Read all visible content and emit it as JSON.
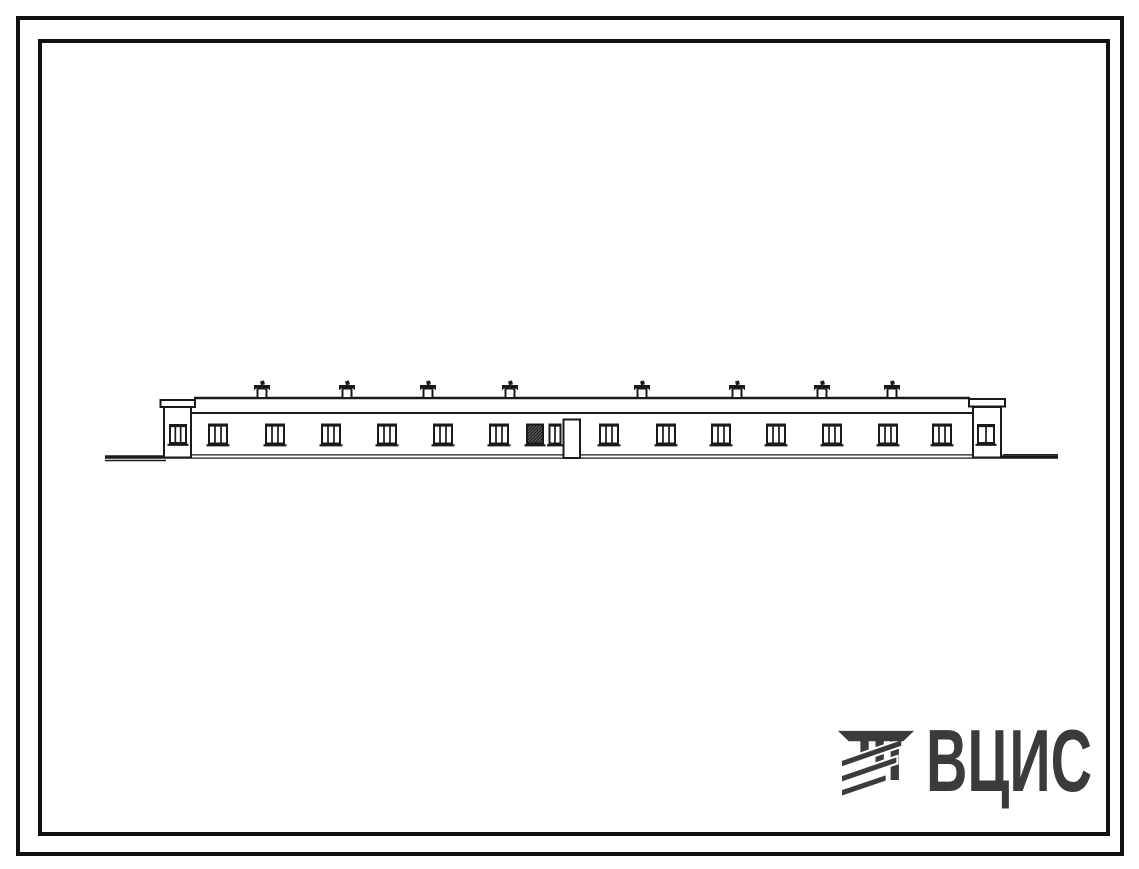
{
  "page": {
    "background": "#ffffff",
    "ink": "#1a1a1a"
  },
  "frame": {
    "style": "double rectangular plate border",
    "border_color": "#111111"
  },
  "logo": {
    "text": "ВЦИС",
    "color": "#3b3b3d",
    "icon": "hatched-beam-monogram"
  },
  "drawing": {
    "subject": "front elevation of long single-story building",
    "ground": {
      "x1": 105,
      "x2": 1058,
      "y": 457
    },
    "building": {
      "left": 191,
      "right": 973,
      "wall_top": 413,
      "roof_line_y": 398,
      "roof_x1": 194,
      "roof_x2": 970,
      "bottom": 457.5
    },
    "end_blocks": {
      "left": {
        "body": {
          "x": 164,
          "y": 407,
          "w": 27,
          "h": 50.5
        },
        "cap": {
          "x": 160.5,
          "y": 400,
          "w": 34.5,
          "h": 7
        },
        "window": {
          "x": 170,
          "y": 425,
          "w": 16,
          "h": 18,
          "panes": 3
        }
      },
      "right": {
        "body": {
          "x": 973,
          "y": 407,
          "w": 28,
          "h": 50.5
        },
        "cap": {
          "x": 969,
          "y": 399,
          "w": 36,
          "h": 7.5
        },
        "window": {
          "x": 978,
          "y": 425,
          "w": 16,
          "h": 18,
          "panes": 2
        }
      }
    },
    "windows": {
      "y": 424.5,
      "w": 18,
      "h": 19,
      "panes": 3,
      "xs": [
        209,
        266,
        322,
        378,
        434,
        490,
        600,
        657,
        712,
        767,
        823,
        879,
        933
      ]
    },
    "dark_window": {
      "x": 527,
      "y": 424.5,
      "w": 16,
      "h": 19
    },
    "narrow_window": {
      "x": 549.5,
      "y": 424.5,
      "w": 11,
      "h": 19,
      "panes": 2
    },
    "door": {
      "x": 563.5,
      "y": 419.5,
      "w": 16.5,
      "bottom": 458
    },
    "roof_vents": {
      "roof_y": 398,
      "xs": [
        262,
        347,
        428,
        510,
        642,
        737,
        822,
        892
      ]
    }
  }
}
